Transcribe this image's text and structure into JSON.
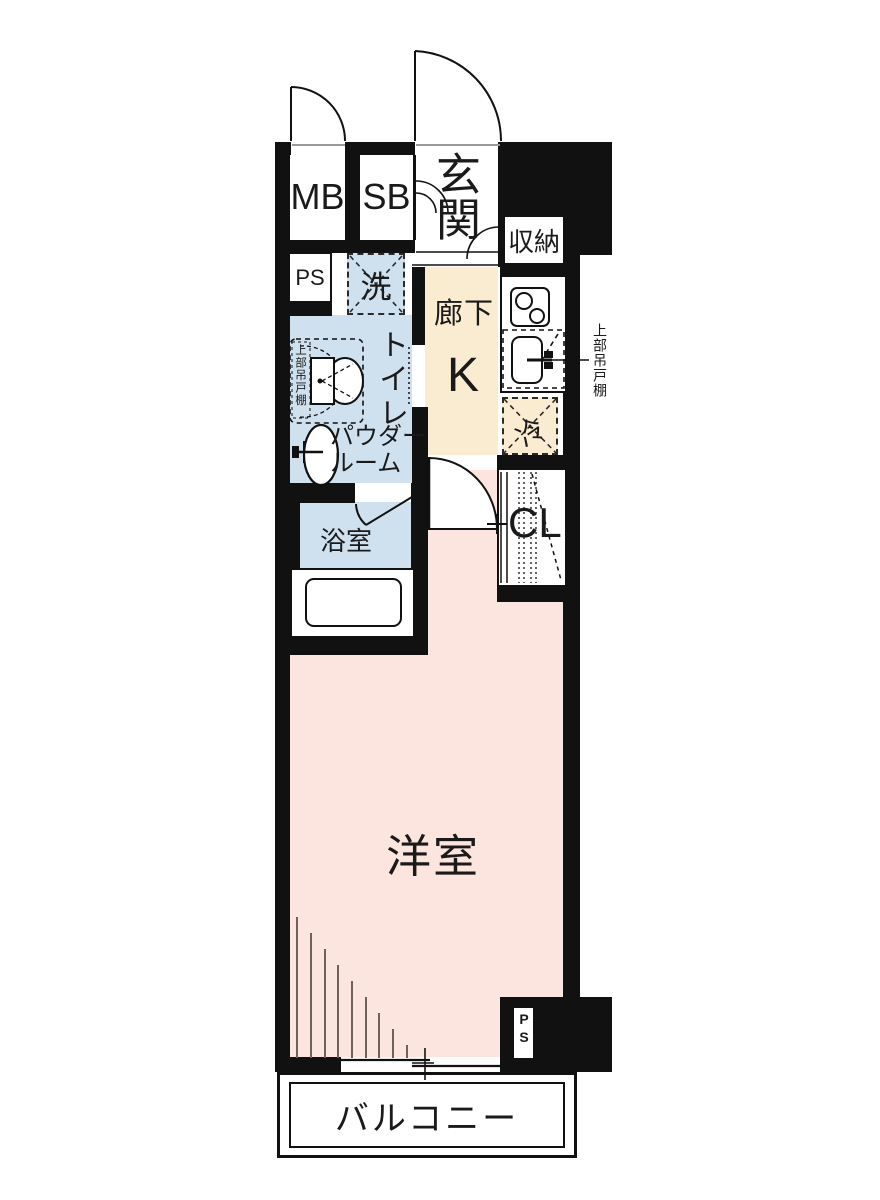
{
  "plan_title": "ワンルーム間取り図",
  "labels": {
    "meter_box": "MB",
    "shoe_box": "SB",
    "entrance": "玄関",
    "storage": "収納",
    "pipe_space_top": "PS",
    "laundry": "洗",
    "hallway": "廊下",
    "kitchen": "K",
    "toilet": "トイレ",
    "powder_room_line1": "パウダー",
    "powder_room_line2": "ルーム",
    "bathroom": "浴室",
    "closet": "CL",
    "refrigerator": "冷",
    "upper_cabinet_left": "上部吊戸棚",
    "upper_cabinet_right": "上部吊戸棚",
    "western_room": "洋室",
    "balcony": "バルコニー",
    "pipe_space_bottom": "PS"
  },
  "colors": {
    "wall": "#111111",
    "western_room_pink": "#fbe5de",
    "wet_area_blue": "#cfe1ef",
    "hall_kitchen_beige": "#f9ecd0",
    "text": "#1a1a1a",
    "window_hatch": "#6f6058"
  }
}
